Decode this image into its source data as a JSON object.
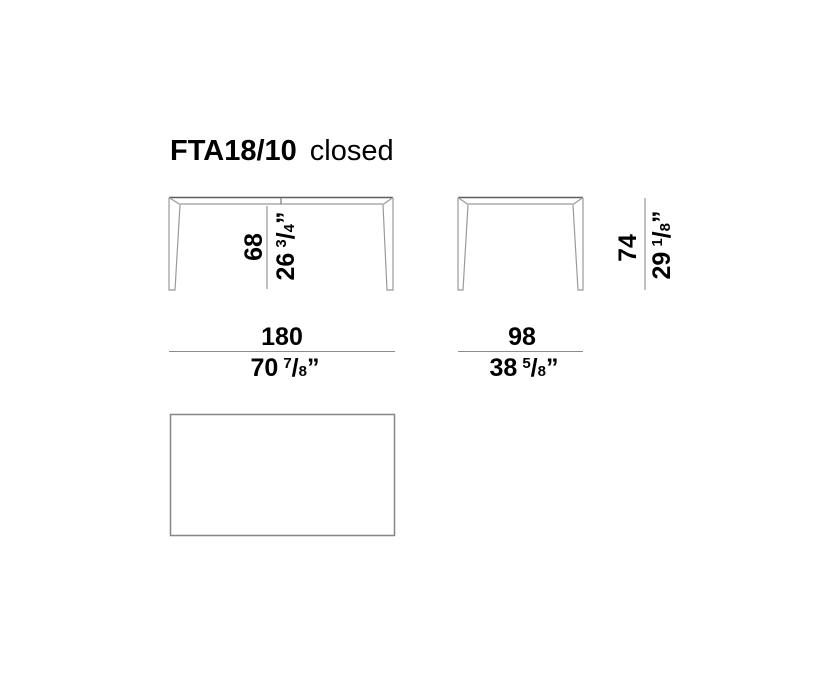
{
  "title": {
    "model": "FTA18/10",
    "variant": "closed"
  },
  "colors": {
    "text": "#000000",
    "drawing_top_edge": "#5f5f5f",
    "drawing_line": "#9a9a9a",
    "dimension_line": "#8c8c8c",
    "background": "#ffffff"
  },
  "views": {
    "front": {
      "name": "front view",
      "height": {
        "cm": "68",
        "inch_whole": "26",
        "frac_num": "3",
        "frac_slash": "/",
        "frac_den": "4",
        "inch_mark": "”"
      },
      "width": {
        "cm": "180",
        "inch_whole": "70",
        "frac_num": "7",
        "frac_slash": "/",
        "frac_den": "8",
        "inch_mark": "”"
      }
    },
    "side": {
      "name": "side view",
      "height": {
        "cm": "74",
        "inch_whole": "29",
        "frac_num": "1",
        "frac_slash": "/",
        "frac_den": "8",
        "inch_mark": "”"
      },
      "width": {
        "cm": "98",
        "inch_whole": "38",
        "frac_num": "5",
        "frac_slash": "/",
        "frac_den": "8",
        "inch_mark": "”"
      }
    }
  }
}
